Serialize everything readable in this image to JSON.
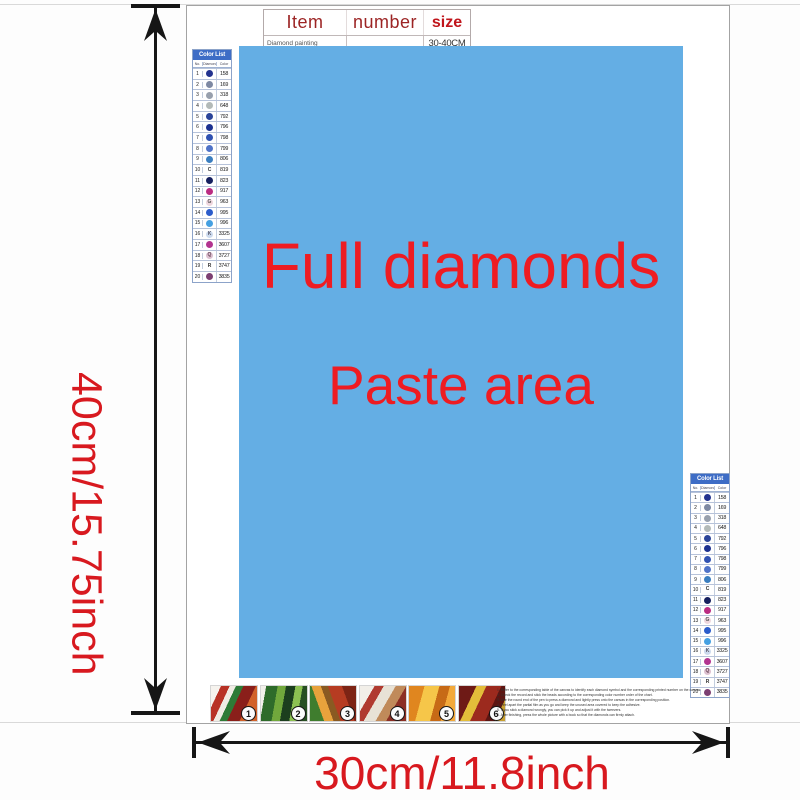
{
  "colors": {
    "paste_bg": "#64aee4",
    "paste_text": "#ee1c22",
    "dim_text": "#d8191f",
    "arrow": "#161616"
  },
  "item_table": {
    "headers": [
      "Item",
      "number",
      "size"
    ],
    "row": {
      "item": "Diamond painting",
      "number": "",
      "size": "30-40CM"
    }
  },
  "paste_area": {
    "line1": "Full diamonds",
    "line2": "Paste area"
  },
  "color_list": {
    "title": "Color List",
    "columns": [
      "No.",
      "Diamond",
      "Color"
    ],
    "rows": [
      {
        "no": "1",
        "code": "158",
        "circle": "#23338f",
        "sym": "",
        "symc": "#ffffff"
      },
      {
        "no": "2",
        "code": "169",
        "circle": "#7e89a3",
        "sym": "",
        "symc": "#ffffff"
      },
      {
        "no": "3",
        "code": "318",
        "circle": "#98a0ad",
        "sym": "",
        "symc": "#ffffff"
      },
      {
        "no": "4",
        "code": "648",
        "circle": "#b3bab8",
        "sym": "",
        "symc": "#555555"
      },
      {
        "no": "5",
        "code": "792",
        "circle": "#2a4499",
        "sym": "",
        "symc": "#ffffff"
      },
      {
        "no": "6",
        "code": "796",
        "circle": "#1c3190",
        "sym": "",
        "symc": "#ffffff"
      },
      {
        "no": "7",
        "code": "798",
        "circle": "#3052b2",
        "sym": "",
        "symc": "#ffffff"
      },
      {
        "no": "8",
        "code": "799",
        "circle": "#4f73c8",
        "sym": "",
        "symc": "#ffffff"
      },
      {
        "no": "9",
        "code": "806",
        "circle": "#3a7ec0",
        "sym": "",
        "symc": "#ffffff"
      },
      {
        "no": "10",
        "code": "819",
        "circle": "",
        "sym": "C",
        "symc": "#333333"
      },
      {
        "no": "11",
        "code": "823",
        "circle": "#16205f",
        "sym": "",
        "symc": "#ffffff"
      },
      {
        "no": "12",
        "code": "917",
        "circle": "#bb2c82",
        "sym": "",
        "symc": "#ffffff"
      },
      {
        "no": "13",
        "code": "963",
        "circle": "#eed6de",
        "sym": "G",
        "symc": "#555555"
      },
      {
        "no": "14",
        "code": "995",
        "circle": "#2b5ccb",
        "sym": "",
        "symc": "#ffffff"
      },
      {
        "no": "15",
        "code": "996",
        "circle": "#45a0e2",
        "sym": "",
        "symc": "#ffffff"
      },
      {
        "no": "16",
        "code": "3325",
        "circle": "#ccdaee",
        "sym": "K",
        "symc": "#555566"
      },
      {
        "no": "17",
        "code": "3607",
        "circle": "#b23490",
        "sym": "",
        "symc": "#ffffff"
      },
      {
        "no": "18",
        "code": "3727",
        "circle": "#dcc0d0",
        "sym": "Q",
        "symc": "#664455"
      },
      {
        "no": "19",
        "code": "3747",
        "circle": "",
        "sym": "R",
        "symc": "#333333"
      },
      {
        "no": "20",
        "code": "3835",
        "circle": "#7c3f72",
        "sym": "",
        "symc": "#ffffff"
      }
    ]
  },
  "steps": [
    {
      "num": "1",
      "bg": "linear-gradient(115deg,#f6f3ee 0 16%,#b83226 16% 30%,#f0ece4 30% 40%,#2e7b36 40% 52%,#8a1f1a 52% 72%,#d2622a 72% 100%)"
    },
    {
      "num": "2",
      "bg": "linear-gradient(100deg,#f2f0ea 0 10%,#2e6b2a 10% 32%,#71a83c 32% 48%,#1c3f1e 48% 66%,#8cc152 66% 80%,#274f22 80% 100%)"
    },
    {
      "num": "3",
      "bg": "linear-gradient(70deg,#3f7d2e 0 24%,#e8a23c 24% 40%,#8a5a22 40% 52%,#b63c22 52% 76%,#7d2415 76% 100%)"
    },
    {
      "num": "4",
      "bg": "linear-gradient(120deg,#f2efe9 0 22%,#b03a30 22% 36%,#e8e2d6 36% 54%,#c08a5a 54% 70%,#8c2f24 70% 100%)"
    },
    {
      "num": "5",
      "bg": "linear-gradient(105deg,#e0861f 0 28%,#f6c649 28% 55%,#c76a16 55% 74%,#f3a93a 74% 100%)"
    },
    {
      "num": "6",
      "bg": "linear-gradient(115deg,#6e1a16 0 28%,#e3bd3a 28% 44%,#9c2a1e 44% 68%,#5c1512 68% 84%,#c8a032 84% 100%)"
    }
  ],
  "fine_print_lines": [
    "1. Refer to the corresponding table of the canvas to identify each diamond symbol and the corresponding printed number on the canvas.",
    "2. Check the record and stick the beads according to the corresponding color number order of the chart.",
    "3. Use the round end of the pen to press a diamond and lightly press onto the canvas in the corresponding position.",
    "4. Peel apart the partial film as you go and keep the unused area covered to keep the adhesive.",
    "5. If you stick a diamond wrongly, you can pick it up and adjust it with the tweezers.",
    "6. After finishing, press the whole picture with a book so that the diamonds can firmly attach."
  ],
  "dimensions": {
    "height_label": "40cm/15.75inch",
    "width_label": "30cm/11.8inch"
  }
}
